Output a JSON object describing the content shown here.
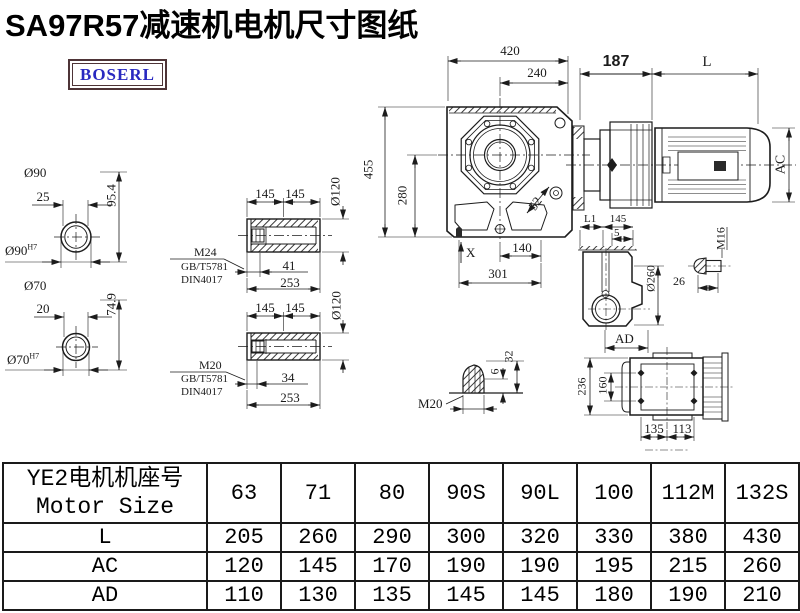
{
  "title": "SA97R57减速机电机尺寸图纸",
  "logo": {
    "text": "BOSERL"
  },
  "colors": {
    "logo_text": "#2929c0",
    "logo_border": "#4e3437",
    "line": "#1c1c1c",
    "background": "#ffffff"
  },
  "drawing": {
    "labels": {
      "phi90": "Ø90",
      "d25": "25",
      "d95_4": "95.4",
      "phi90h7_base": "Ø90",
      "h7": "H7",
      "phi70": "Ø70",
      "d20": "20",
      "d74_9": "74.9",
      "phi70h7_base": "Ø70",
      "d145": "145",
      "phi120": "Ø120",
      "m24": "M24",
      "gb": "GB/T5781",
      "din": "DIN4017",
      "d41": "41",
      "d253": "253",
      "m20": "M20",
      "d34": "34",
      "d420": "420",
      "d240": "240",
      "d455": "455",
      "d280": "280",
      "d52": "52",
      "dx": "X",
      "d140": "140",
      "d301": "301",
      "d187": "187",
      "L": "L",
      "AC": "AC",
      "L1": "L1",
      "d5": "5",
      "phi260": "Ø260",
      "AD": "AD",
      "m16": "M16",
      "d26": "26",
      "d6": "6",
      "d32": "32",
      "d236": "236",
      "d160": "160",
      "d135": "135",
      "d113": "113"
    }
  },
  "table": {
    "header_line1": "YE2电机机座号",
    "header_line2": "Motor Size",
    "columns": [
      "63",
      "71",
      "80",
      "90S",
      "90L",
      "100",
      "112M",
      "132S"
    ],
    "rows": [
      {
        "label": "L",
        "values": [
          "205",
          "260",
          "290",
          "300",
          "320",
          "330",
          "380",
          "430"
        ]
      },
      {
        "label": "AC",
        "values": [
          "120",
          "145",
          "170",
          "190",
          "190",
          "195",
          "215",
          "260"
        ]
      },
      {
        "label": "AD",
        "values": [
          "110",
          "130",
          "135",
          "145",
          "145",
          "180",
          "190",
          "210"
        ]
      }
    ]
  }
}
